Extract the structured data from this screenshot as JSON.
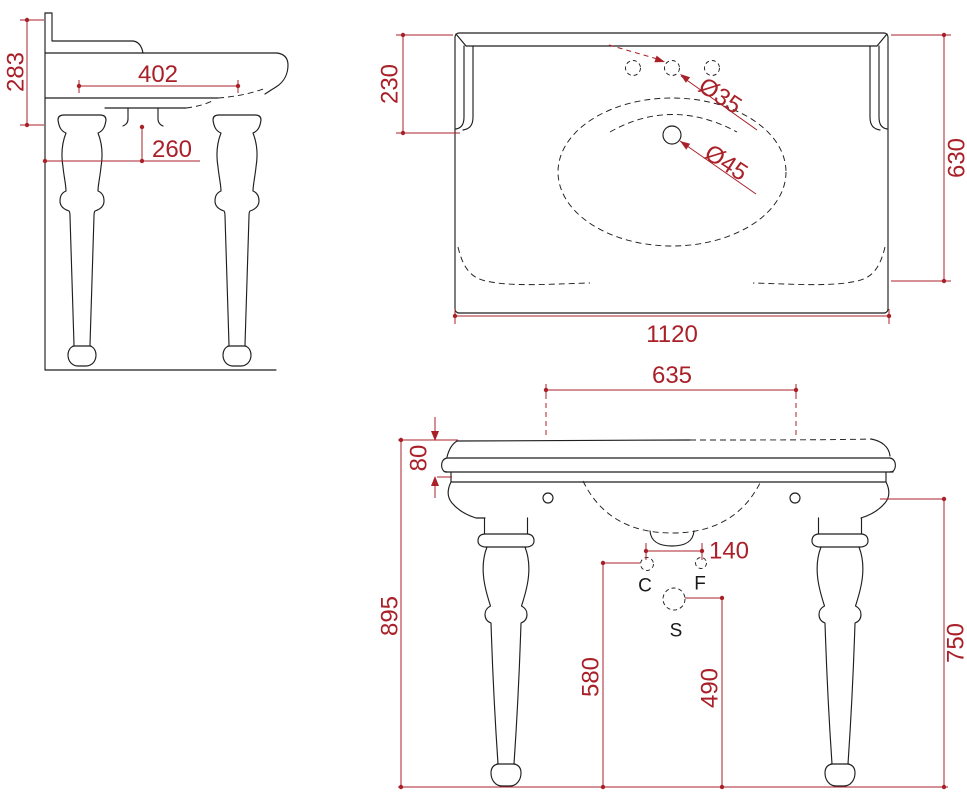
{
  "colors": {
    "outline": "#1f1f1f",
    "dimension": "#a92028",
    "background": "#ffffff"
  },
  "side_view": {
    "overall_depth": "283",
    "basin_inner_depth": "402",
    "drain_offset_from_wall": "260"
  },
  "top_view": {
    "backsplash_depth": "230",
    "overall_depth": "630",
    "overall_width": "1120",
    "faucet_hole_diameter": "Ø35",
    "drain_hole_diameter": "Ø45"
  },
  "front_view": {
    "tap_deck_span": "635",
    "counter_edge_thickness": "80",
    "overall_height": "895",
    "supply_spacing": "140",
    "supply_height": "580",
    "waste_height": "490",
    "leg_height": "750",
    "label_c": "C",
    "label_f": "F",
    "label_s": "S"
  }
}
